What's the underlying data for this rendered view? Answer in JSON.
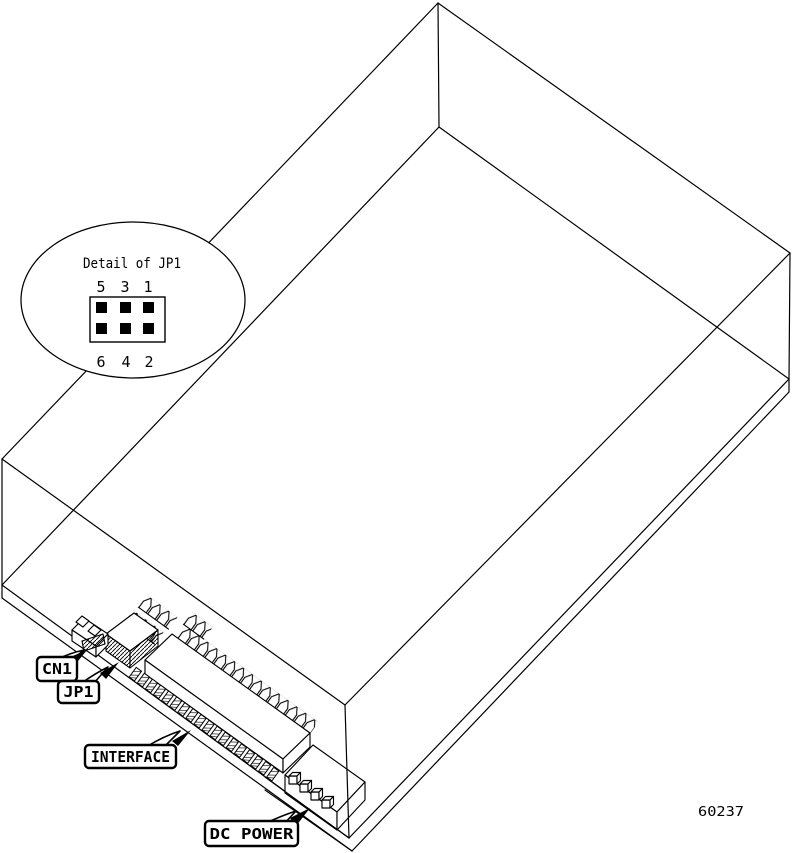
{
  "diagram": {
    "figure_number": "60237",
    "detail_bubble": {
      "title": "Detail of JP1",
      "pin_labels_top": [
        "5",
        "3",
        "1"
      ],
      "pin_labels_bottom": [
        "6",
        "4",
        "2"
      ]
    },
    "labels": {
      "cn1": "CN1",
      "jp1": "JP1",
      "interface": "INTERFACE",
      "dc_power": "DC POWER"
    },
    "colors": {
      "line": "#000000",
      "background": "#ffffff"
    }
  }
}
